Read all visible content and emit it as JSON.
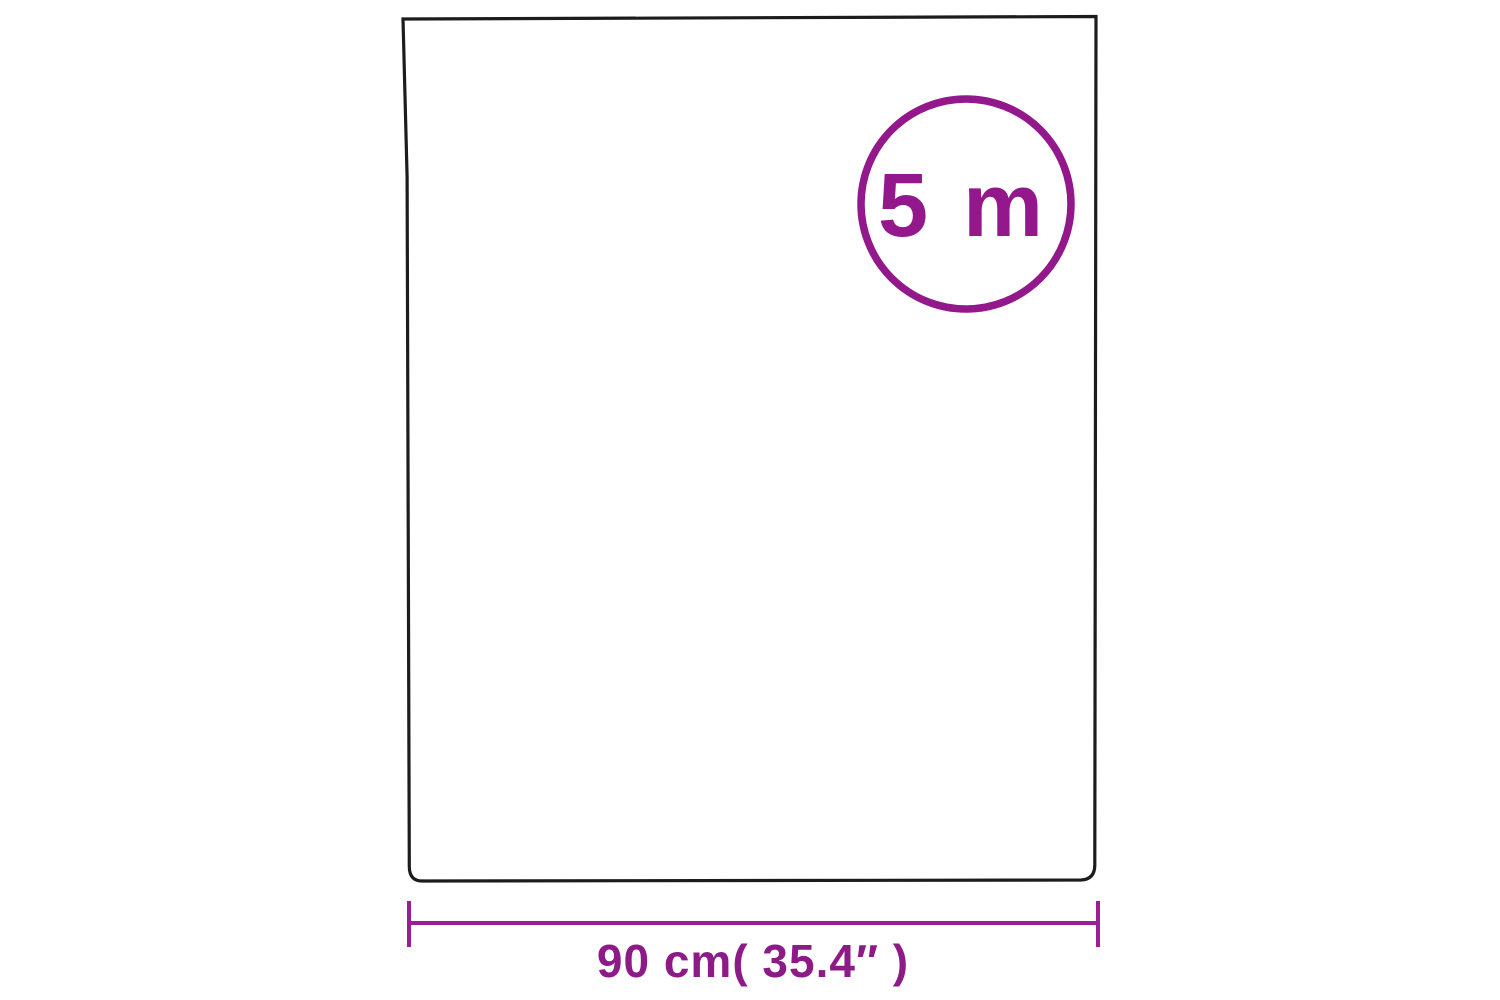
{
  "page": {
    "background": "#ffffff"
  },
  "colors": {
    "sheet_outline": "#1c1c1c",
    "badge": "#92188c",
    "dimension_line": "#9c1d94",
    "dimension_label": "#8d1b87"
  },
  "badge": {
    "label": "5 m"
  },
  "dimension": {
    "label": "90 cm( 35.4″ )"
  }
}
